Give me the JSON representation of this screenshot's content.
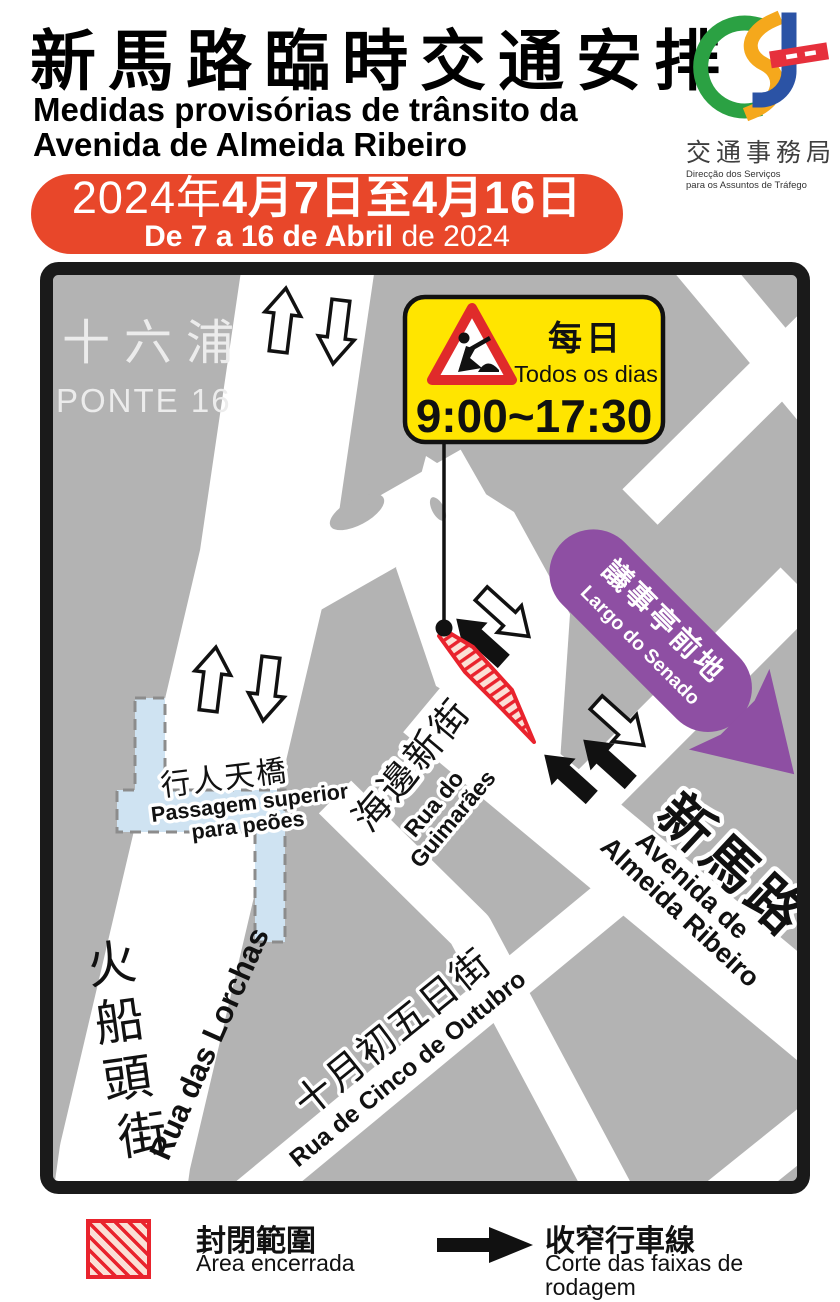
{
  "header": {
    "title_zh": "新馬路臨時交通安排",
    "subtitle_pt_line1": "Medidas provisórias de trânsito da",
    "subtitle_pt_line2": "Avenida de Almeida Ribeiro",
    "date_banner": {
      "zh_year": "2024年",
      "zh_dates": "4月7日至4月16日",
      "pt_bold": "De 7 a 16 de Abril",
      "pt_regular": " de 2024",
      "bg_color": "#e8472a"
    },
    "logo": {
      "agency_zh": "交通事務局",
      "agency_pt_line1": "Direcção dos Serviços",
      "agency_pt_line2": "para os Assuntos de Tráfego",
      "colors": {
        "green": "#2ba143",
        "yellow": "#f5a81c",
        "blue": "#2b53a5",
        "red": "#e6303c"
      }
    }
  },
  "map": {
    "colors": {
      "building_gray": "#b3b3b3",
      "road_white": "#ffffff",
      "border_black": "#1a1a1a",
      "closure_red": "#e9232d",
      "bridge_blue": "#cfe3f2",
      "senado_purple": "#8e4fa3",
      "callout_yellow": "#ffe500"
    },
    "ponte16": {
      "zh": "十六浦",
      "pt": "PONTE 16"
    },
    "callout": {
      "zh": "每日",
      "pt": "Todos os dias",
      "time": "9:00~17:30"
    },
    "senado": {
      "zh": "議事亭前地",
      "pt": "Largo do Senado"
    },
    "bridge": {
      "zh": "行人天橋",
      "pt_line1": "Passagem superior",
      "pt_line2": "para peões"
    },
    "streets": {
      "guimaraes": {
        "zh": "海邊新街",
        "pt_line1": "Rua do",
        "pt_line2": "Guimarães"
      },
      "almeida": {
        "zh": "新馬路",
        "pt_line1": "Avenida de",
        "pt_line2": "Almeida Ribeiro"
      },
      "lorchas": {
        "zh_chars": [
          "火",
          "船",
          "頭",
          "街"
        ],
        "pt": "Rua das Lorchas"
      },
      "outubro": {
        "zh": "十月初五日街",
        "pt": "Rua de Cinco de Outubro"
      }
    }
  },
  "legend": {
    "closed_area": {
      "zh": "封閉範圍",
      "pt": "Área encerrada"
    },
    "narrowed_lanes": {
      "zh": "收窄行車線",
      "pt_line1": "Corte das faixas de",
      "pt_line2": "rodagem"
    }
  }
}
